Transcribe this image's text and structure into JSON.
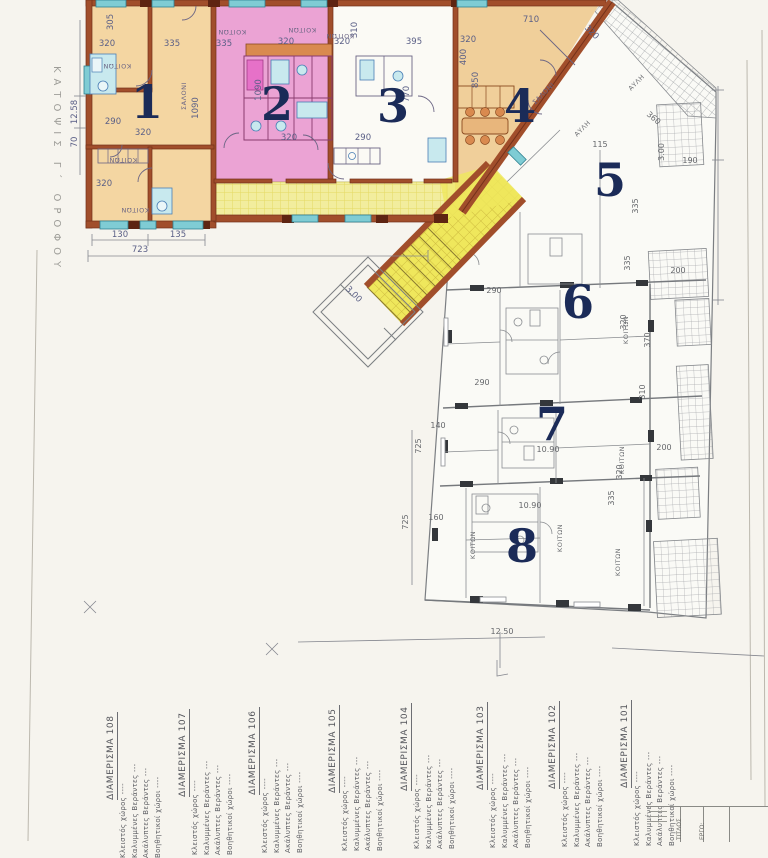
{
  "plan": {
    "sheet_title_vertical": "ΚΑΤΟΨΙΣ  Γ΄  ΟΡΟΦΟΥ",
    "apartments": [
      "1",
      "2",
      "3",
      "4",
      "5",
      "6",
      "7",
      "8"
    ],
    "colors": {
      "apartment1_fill": "#f4d6a2",
      "apartment2_fill": "#eba3d4",
      "apartment4_fill": "#f0cf9a",
      "corridor_fill": "#efe75c",
      "wall_brown": "#a14e2b",
      "window_teal": "#7fccd4",
      "fixture_blue": "#c8e9ee",
      "number_navy": "#1b2b58"
    },
    "dims": [
      "320",
      "335",
      "335",
      "320",
      "320",
      "395",
      "320",
      "710",
      "305",
      "310",
      "1090",
      "1090",
      "290",
      "320",
      "320",
      "850",
      "400",
      "770",
      "290",
      "320",
      "3.00",
      "130",
      "135",
      "723",
      "12.58",
      "70",
      "360",
      "3.00",
      "190",
      "115",
      "335",
      "200",
      "370",
      "310",
      "200",
      "335",
      "290",
      "320",
      "290",
      "320",
      "10.90",
      "10.90",
      "335",
      "140",
      "160",
      "12.50",
      "725",
      "725",
      "320"
    ],
    "rooms": [
      "ΚΟΙΤΩΝ",
      "ΣΑΛΟΝΙ",
      "ΑΥΛΗ"
    ]
  },
  "schedule": {
    "columns": [
      {
        "name": "ΔΙΑΜΕΡΙΣΜΑ  101"
      },
      {
        "name": "ΔΙΑΜΕΡΙΣΜΑ  102"
      },
      {
        "name": "ΔΙΑΜΕΡΙΣΜΑ  103"
      },
      {
        "name": "ΔΙΑΜΕΡΙΣΜΑ  104"
      },
      {
        "name": "ΔΙΑΜΕΡΙΣΜΑ  105"
      },
      {
        "name": "ΔΙΑΜΕΡΙΣΜΑ  106"
      },
      {
        "name": "ΔΙΑΜΕΡΙΣΜΑ  107"
      },
      {
        "name": "ΔΙΑΜΕΡΙΣΜΑ  108"
      }
    ],
    "rows": [
      "Κλειστός χώρος ----",
      "Καλυμμένες Βεράντες ---",
      "Ακάλυπτες Βεράντες ---",
      "Βοηθητικοί χώροι ----"
    ]
  },
  "title_block": {
    "cells": [
      "ΤΙΤΛΟΣ",
      "ΕΡΓΟ:"
    ]
  }
}
